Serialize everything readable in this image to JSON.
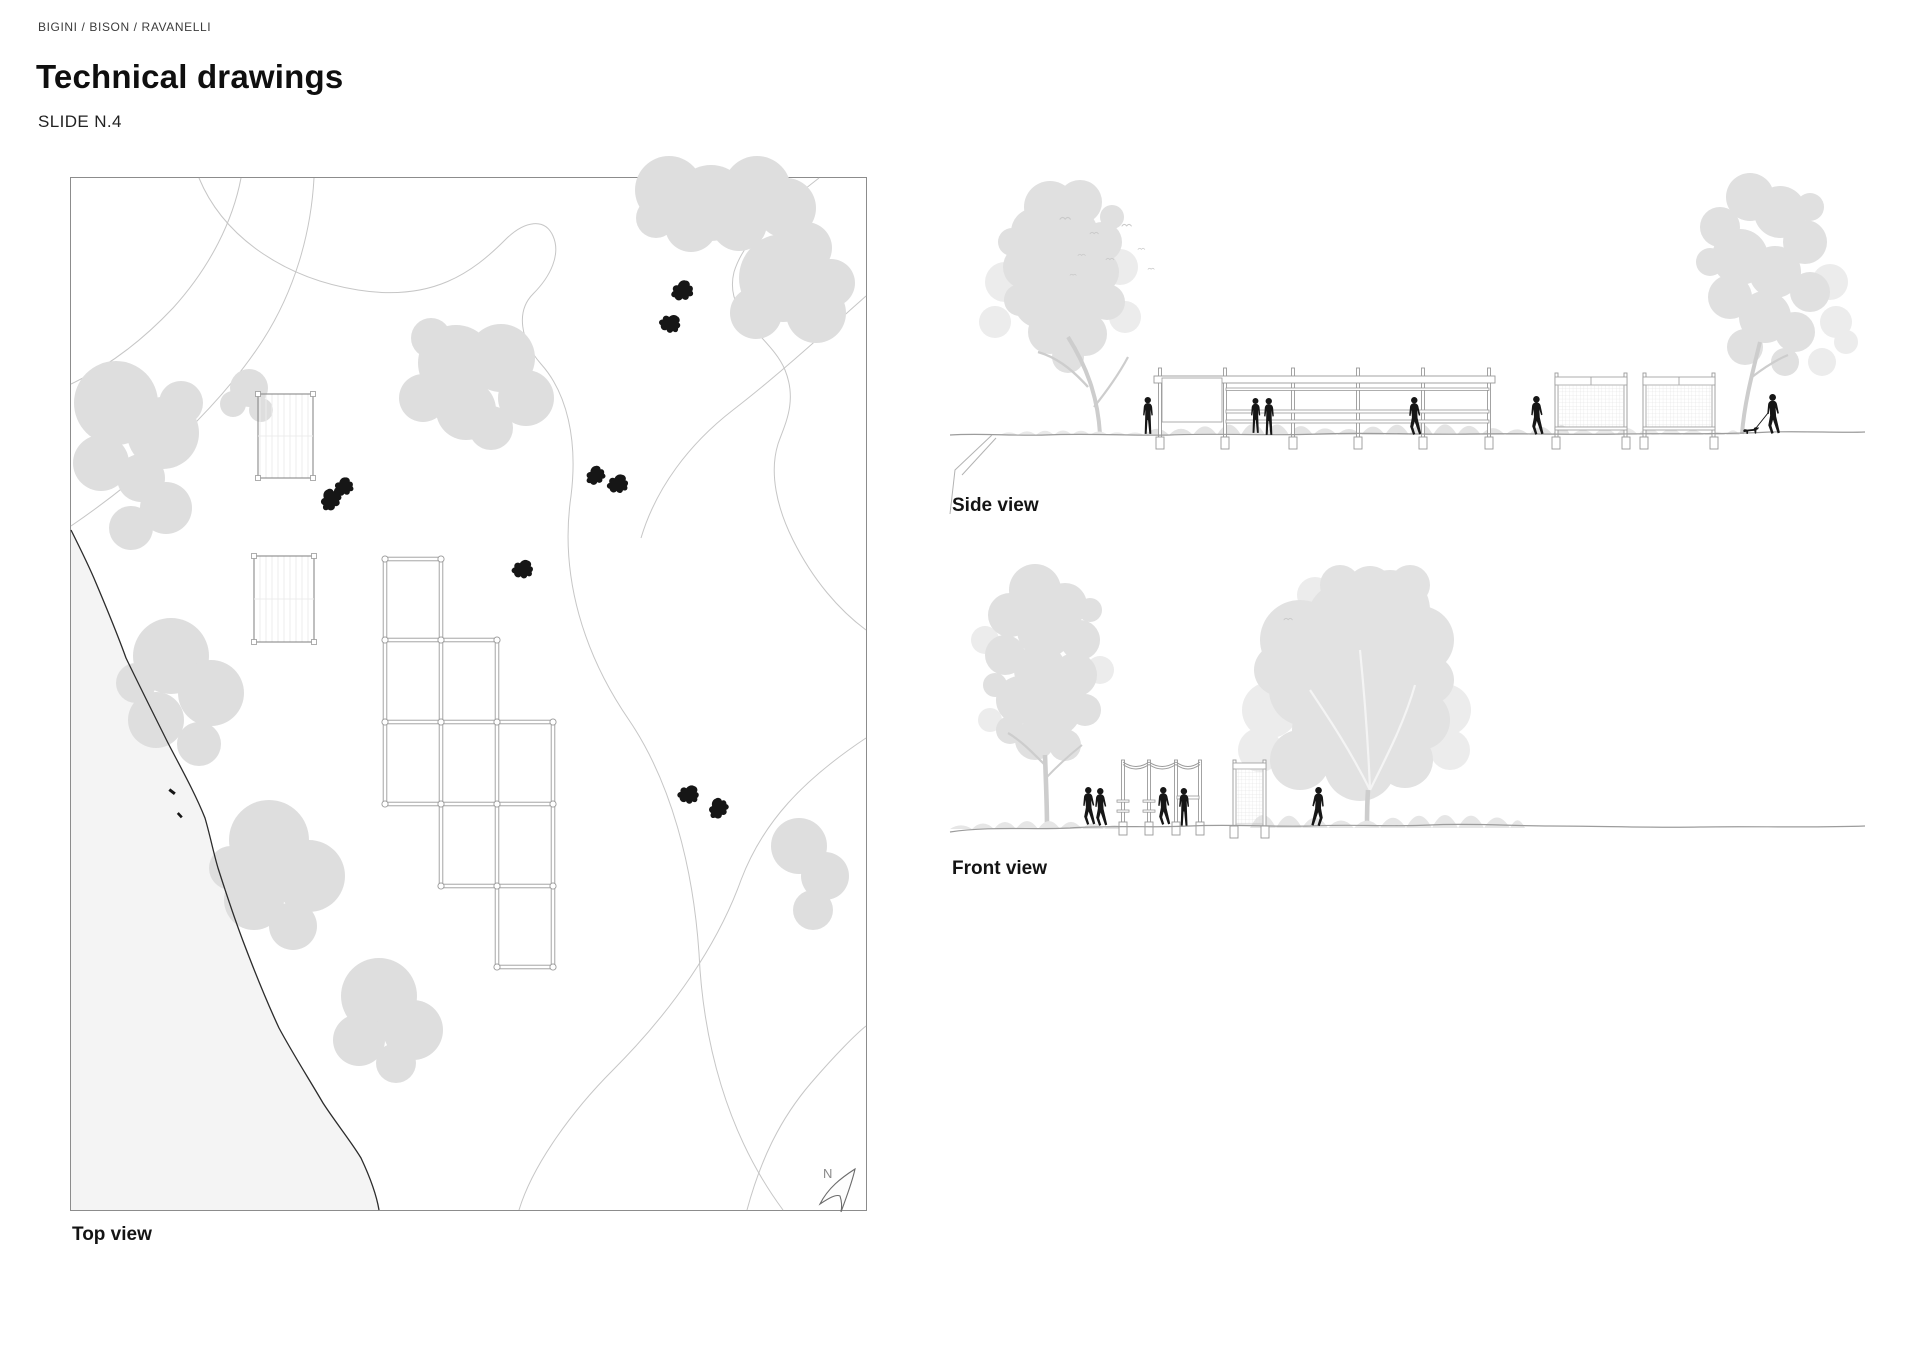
{
  "header": {
    "credits": "BIGINI / BISON / RAVANELLI",
    "title": "Technical drawings",
    "slide": "SLIDE N.4"
  },
  "views": {
    "top": {
      "label": "Top view"
    },
    "side": {
      "label": "Side view"
    },
    "front": {
      "label": "Front view"
    }
  },
  "compass": {
    "label": "N"
  },
  "colors": {
    "canopy": "#dedede",
    "canopy_light": "#ececec",
    "canopy_elev": "#e0e0e0",
    "contour": "#c6c6c6",
    "structure": "#9a9a9a",
    "figure": "#161616",
    "water": "#f4f4f4",
    "shoreline": "#2b2b2b",
    "panel_border": "#8c8c8c",
    "ground": "#9c9c9c",
    "shrub": "#e3e3e3",
    "text": "#0f0f0f"
  }
}
